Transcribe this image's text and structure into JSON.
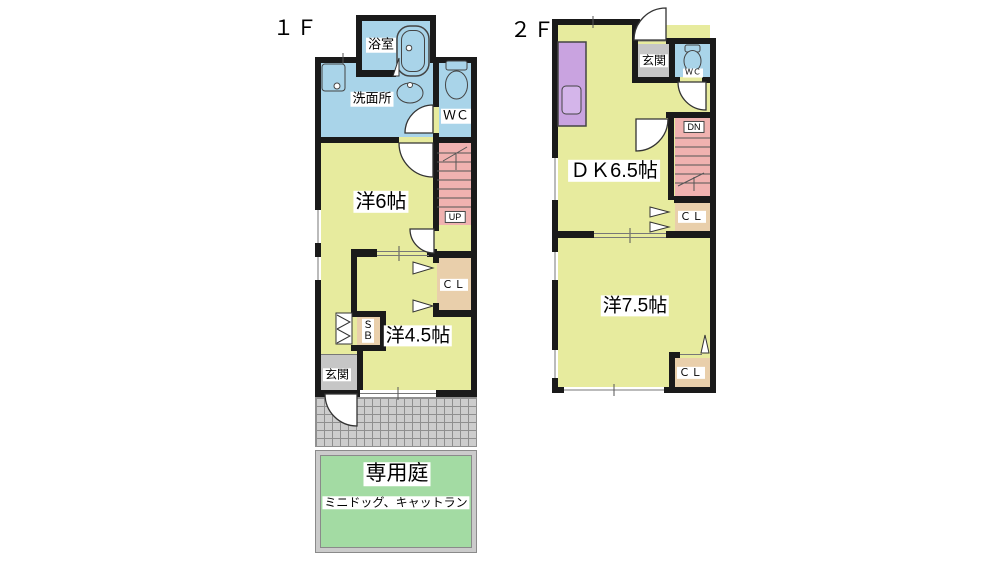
{
  "floor1": {
    "floor_label": "１Ｆ",
    "rooms": {
      "bath": "浴室",
      "washroom": "洗面所",
      "toilet": "ＷＣ",
      "western6": "洋6帖",
      "western45": "洋4.5帖",
      "entrance": "玄関"
    },
    "storage": {
      "closet": "ＣＬ",
      "shoebox": "ＳＢ"
    },
    "stairs_label": "UP"
  },
  "floor2": {
    "floor_label": "２Ｆ",
    "rooms": {
      "entrance": "玄関",
      "toilet": "ＷＣ",
      "dining_kitchen": "ＤＫ6.5帖",
      "western75": "洋7.5帖"
    },
    "storage": {
      "closet_hall": "ＣＬ",
      "closet_room": "ＣＬ"
    },
    "stairs_label": "DN"
  },
  "garden": {
    "title": "専用庭",
    "subtitle": "ミニドッグ、キャットラン"
  },
  "colors": {
    "wall": "#1a1a1a",
    "room_yellow": "#e7eb9e",
    "water_blue": "#a9d4e9",
    "stairs_pink": "#f0b2b0",
    "closet_tan": "#e9cfab",
    "kitchen_purple": "#c9a3e0",
    "entrance_gray": "#c6c6c6",
    "garden_green": "#a3dba3",
    "tile_gray": "#cdcdcd"
  }
}
